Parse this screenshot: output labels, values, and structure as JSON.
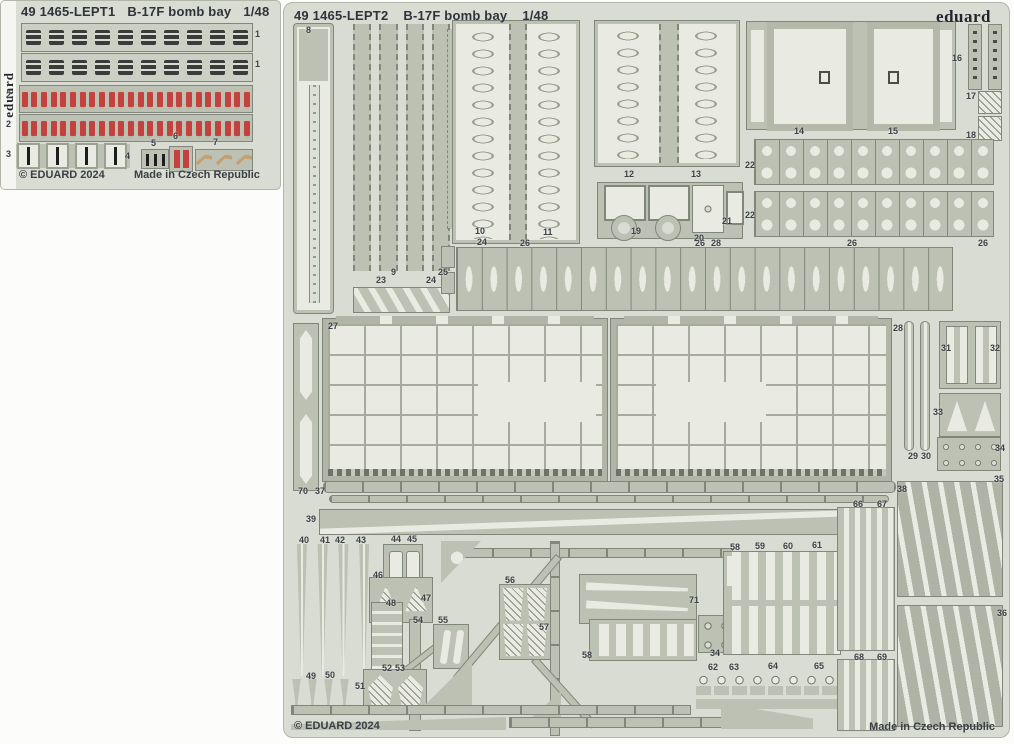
{
  "colors": {
    "page": "#fcfcfa",
    "sheet": "#d9dcd2",
    "metal": "#bcc1b4",
    "metal_dark": "#81867a",
    "etch": "#e9ebe2",
    "ink": "#2f333b",
    "label": "#3d4147",
    "dark_part": "#3b3b3b",
    "red": "#c4423e",
    "tan": "#c2a072"
  },
  "sheet1": {
    "catalog": "49 1465-LEPT1",
    "title": "B-17F bomb bay",
    "scale": "1/48",
    "brand": "eduard",
    "copyright": "© EDUARD 2024",
    "made_in": "Made in Czech Republic",
    "counts": {
      "buckles": 10,
      "reds": 24,
      "clips": 4,
      "hooks": 3
    },
    "part_labels": [
      {
        "t": "1",
        "x": 254,
        "y": 29
      },
      {
        "t": "1",
        "x": 254,
        "y": 59
      },
      {
        "t": "2",
        "x": 5,
        "y": 90
      },
      {
        "t": "2",
        "x": 5,
        "y": 119
      },
      {
        "t": "3",
        "x": 5,
        "y": 149
      },
      {
        "t": "4",
        "x": 124,
        "y": 151
      },
      {
        "t": "5",
        "x": 150,
        "y": 138
      },
      {
        "t": "6",
        "x": 172,
        "y": 131
      },
      {
        "t": "7",
        "x": 212,
        "y": 137
      }
    ]
  },
  "sheet2": {
    "catalog": "49 1465-LEPT2",
    "title": "B-17F bomb bay",
    "scale": "1/48",
    "brand": "eduard",
    "copyright": "© EDUARD 2024",
    "made_in": "Made in Czech Republic",
    "counts": {
      "strips9": 4,
      "cones": 4,
      "flowers": 8
    },
    "part_labels": [
      {
        "t": "8",
        "x": 22,
        "y": 23
      },
      {
        "t": "23",
        "x": 92,
        "y": 273
      },
      {
        "t": "9",
        "x": 107,
        "y": 265
      },
      {
        "t": "24",
        "x": 142,
        "y": 273
      },
      {
        "t": "25",
        "x": 154,
        "y": 265
      },
      {
        "t": "10",
        "x": 191,
        "y": 224
      },
      {
        "t": "24",
        "x": 193,
        "y": 235
      },
      {
        "t": "11",
        "x": 259,
        "y": 225
      },
      {
        "t": "12",
        "x": 340,
        "y": 167
      },
      {
        "t": "13",
        "x": 407,
        "y": 167
      },
      {
        "t": "26",
        "x": 236,
        "y": 236
      },
      {
        "t": "26",
        "x": 411,
        "y": 236
      },
      {
        "t": "26",
        "x": 563,
        "y": 236
      },
      {
        "t": "26",
        "x": 694,
        "y": 236
      },
      {
        "t": "19",
        "x": 347,
        "y": 224
      },
      {
        "t": "20",
        "x": 410,
        "y": 231
      },
      {
        "t": "28",
        "x": 427,
        "y": 236
      },
      {
        "t": "21",
        "x": 438,
        "y": 214
      },
      {
        "t": "14",
        "x": 510,
        "y": 124
      },
      {
        "t": "15",
        "x": 604,
        "y": 124
      },
      {
        "t": "16",
        "x": 668,
        "y": 51
      },
      {
        "t": "17",
        "x": 682,
        "y": 89
      },
      {
        "t": "18",
        "x": 682,
        "y": 128
      },
      {
        "t": "22",
        "x": 461,
        "y": 158
      },
      {
        "t": "22",
        "x": 461,
        "y": 208
      },
      {
        "t": "27",
        "x": 44,
        "y": 319
      },
      {
        "t": "28",
        "x": 609,
        "y": 321
      },
      {
        "t": "29",
        "x": 624,
        "y": 449
      },
      {
        "t": "30",
        "x": 637,
        "y": 449
      },
      {
        "t": "31",
        "x": 657,
        "y": 341
      },
      {
        "t": "32",
        "x": 706,
        "y": 341
      },
      {
        "t": "33",
        "x": 649,
        "y": 405
      },
      {
        "t": "34",
        "x": 711,
        "y": 441
      },
      {
        "t": "35",
        "x": 710,
        "y": 472
      },
      {
        "t": "36",
        "x": 713,
        "y": 606
      },
      {
        "t": "70",
        "x": 14,
        "y": 484
      },
      {
        "t": "37",
        "x": 31,
        "y": 484
      },
      {
        "t": "38",
        "x": 613,
        "y": 482
      },
      {
        "t": "39",
        "x": 22,
        "y": 512
      },
      {
        "t": "40",
        "x": 15,
        "y": 533
      },
      {
        "t": "41",
        "x": 36,
        "y": 533
      },
      {
        "t": "42",
        "x": 51,
        "y": 533
      },
      {
        "t": "43",
        "x": 72,
        "y": 533
      },
      {
        "t": "44",
        "x": 107,
        "y": 532
      },
      {
        "t": "45",
        "x": 123,
        "y": 532
      },
      {
        "t": "46",
        "x": 89,
        "y": 568
      },
      {
        "t": "47",
        "x": 137,
        "y": 591
      },
      {
        "t": "48",
        "x": 102,
        "y": 596
      },
      {
        "t": "54",
        "x": 129,
        "y": 613
      },
      {
        "t": "55",
        "x": 154,
        "y": 613
      },
      {
        "t": "49",
        "x": 22,
        "y": 669
      },
      {
        "t": "50",
        "x": 41,
        "y": 668
      },
      {
        "t": "51",
        "x": 71,
        "y": 679
      },
      {
        "t": "52",
        "x": 98,
        "y": 661
      },
      {
        "t": "53",
        "x": 111,
        "y": 661
      },
      {
        "t": "56",
        "x": 221,
        "y": 573
      },
      {
        "t": "57",
        "x": 255,
        "y": 620
      },
      {
        "t": "71",
        "x": 405,
        "y": 593
      },
      {
        "t": "58",
        "x": 298,
        "y": 648
      },
      {
        "t": "34",
        "x": 426,
        "y": 646
      },
      {
        "t": "62",
        "x": 424,
        "y": 660
      },
      {
        "t": "63",
        "x": 445,
        "y": 660
      },
      {
        "t": "64",
        "x": 484,
        "y": 659
      },
      {
        "t": "65",
        "x": 530,
        "y": 659
      },
      {
        "t": "58",
        "x": 446,
        "y": 540
      },
      {
        "t": "59",
        "x": 471,
        "y": 539
      },
      {
        "t": "60",
        "x": 499,
        "y": 539
      },
      {
        "t": "61",
        "x": 528,
        "y": 538
      },
      {
        "t": "66",
        "x": 569,
        "y": 497
      },
      {
        "t": "67",
        "x": 593,
        "y": 497
      },
      {
        "t": "68",
        "x": 570,
        "y": 650
      },
      {
        "t": "69",
        "x": 593,
        "y": 650
      }
    ]
  }
}
